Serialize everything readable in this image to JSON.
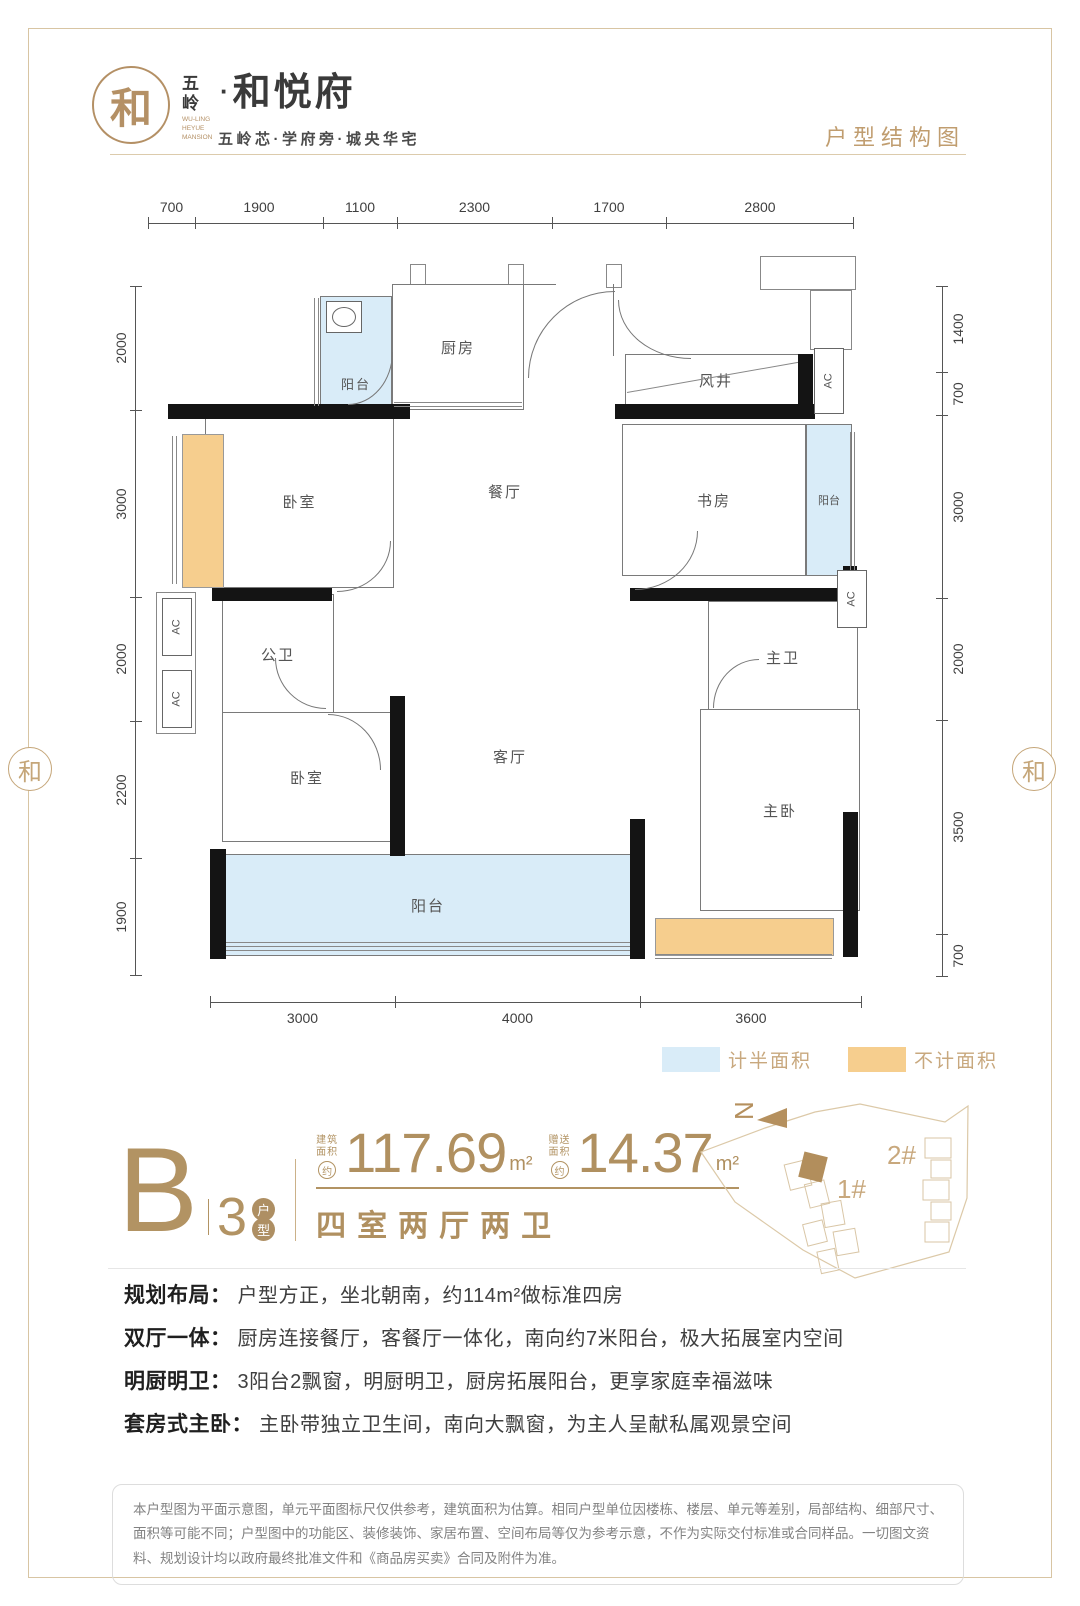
{
  "header": {
    "logo_mark": "和",
    "brand_prefix_1": "五",
    "brand_prefix_2": "岭",
    "brand_dot": "·",
    "brand_name": "和悦府",
    "brand_en": "WU-LING HEYUE MANSION",
    "tagline": "五岭芯·学府旁·城央华宅",
    "page_title": "户型结构图"
  },
  "floorplan": {
    "dims_top": [
      "700",
      "1900",
      "1100",
      "2300",
      "1700",
      "2800"
    ],
    "dims_left": [
      "2000",
      "3000",
      "2000",
      "2200",
      "1900"
    ],
    "dims_right": [
      "1400",
      "700",
      "3000",
      "2000",
      "3500",
      "700"
    ],
    "dims_bottom": [
      "3000",
      "4000",
      "3600"
    ],
    "ac_label": "AC",
    "rooms": {
      "balcony_north": "阳台",
      "kitchen": "厨房",
      "wind_shaft": "风井",
      "bedroom_a": "卧室",
      "dining": "餐厅",
      "study": "书房",
      "balcony_east": "阳台",
      "bath_public": "公卫",
      "bath_master": "主卫",
      "bedroom_b": "卧室",
      "living": "客厅",
      "master_bedroom": "主卧",
      "balcony_south": "阳台"
    }
  },
  "legend": {
    "half_area": "计半面积",
    "half_color": "#D9ECF8",
    "excluded_area": "不计面积",
    "excluded_color": "#F6CE8E"
  },
  "unit": {
    "letter": "B",
    "number": "3",
    "badge_top": "户",
    "badge_bottom": "型",
    "area1_label_1": "建筑",
    "area1_label_2": "面积",
    "area1_approx": "约",
    "area1_value": "117.69",
    "area1_unit": "m²",
    "area2_label_1": "赠送",
    "area2_label_2": "面积",
    "area2_approx": "约",
    "area2_value": "14.37",
    "area2_unit": "m²",
    "layout_desc": "四室两厅两卫"
  },
  "siteplan": {
    "north": "N",
    "building1": "1#",
    "building2": "2#"
  },
  "features": [
    {
      "title": "规划布局：",
      "text": "户型方正，坐北朝南，约114m²做标准四房"
    },
    {
      "title": "双厅一体：",
      "text": "厨房连接餐厅，客餐厅一体化，南向约7米阳台，极大拓展室内空间"
    },
    {
      "title": "明厨明卫：",
      "text": "3阳台2飘窗，明厨明卫，厨房拓展阳台，更享家庭幸福滋味"
    },
    {
      "title": "套房式主卧：",
      "text": "主卧带独立卫生间，南向大飘窗，为主人呈献私属观景空间"
    }
  ],
  "disclaimer": "本户型图为平面示意图，单元平面图标尺仅供参考，建筑面积为估算。相同户型单位因楼栋、楼层、单元等差别，局部结构、细部尺寸、面积等可能不同；户型图中的功能区、装修装饰、家居布置、空间布局等仅为参考示意，不作为实际交付标准或合同样品。一切图文资料、规划设计均以政府最终批准文件和《商品房买卖》合同及附件为准。"
}
